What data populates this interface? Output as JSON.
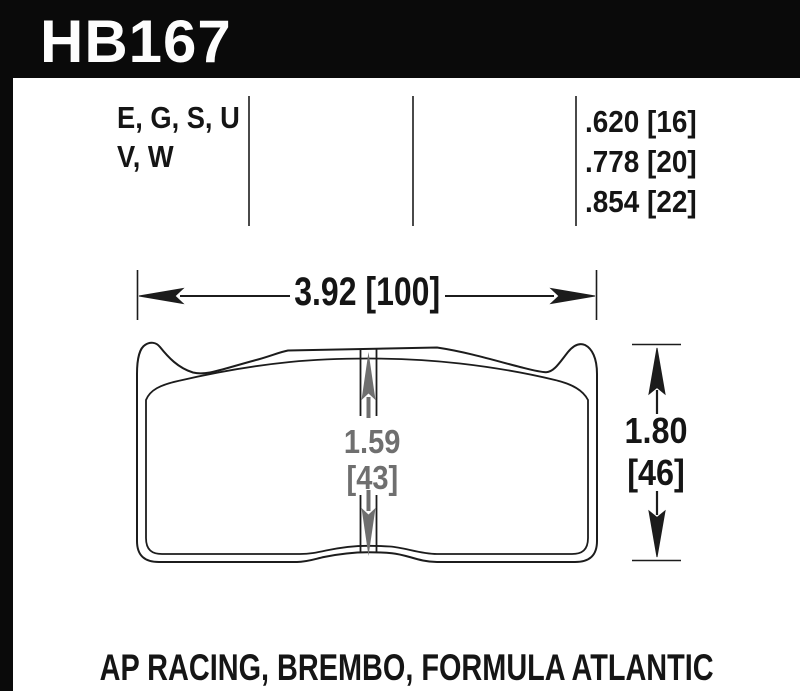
{
  "banner": {
    "part_number": "HB167"
  },
  "spec_table": {
    "compounds": {
      "line1": "E, G, S, U",
      "line2": "V, W"
    },
    "thicknesses": [
      ".620 [16]",
      ".778 [20]",
      ".854 [22]"
    ]
  },
  "dimensions": {
    "width": "3.92 [100]",
    "center_height": {
      "line1": "1.59",
      "line2": "[43]"
    },
    "overall_height": {
      "line1": "1.80",
      "line2": "[46]"
    }
  },
  "footer": {
    "applications": "AP RACING, BREMBO, FORMULA ATLANTIC"
  },
  "colors": {
    "banner_black": "#0a0a0a",
    "ink": "#151515",
    "dimension_gray": "#6f6f6f",
    "divider_gray": "#4a4a4a"
  }
}
